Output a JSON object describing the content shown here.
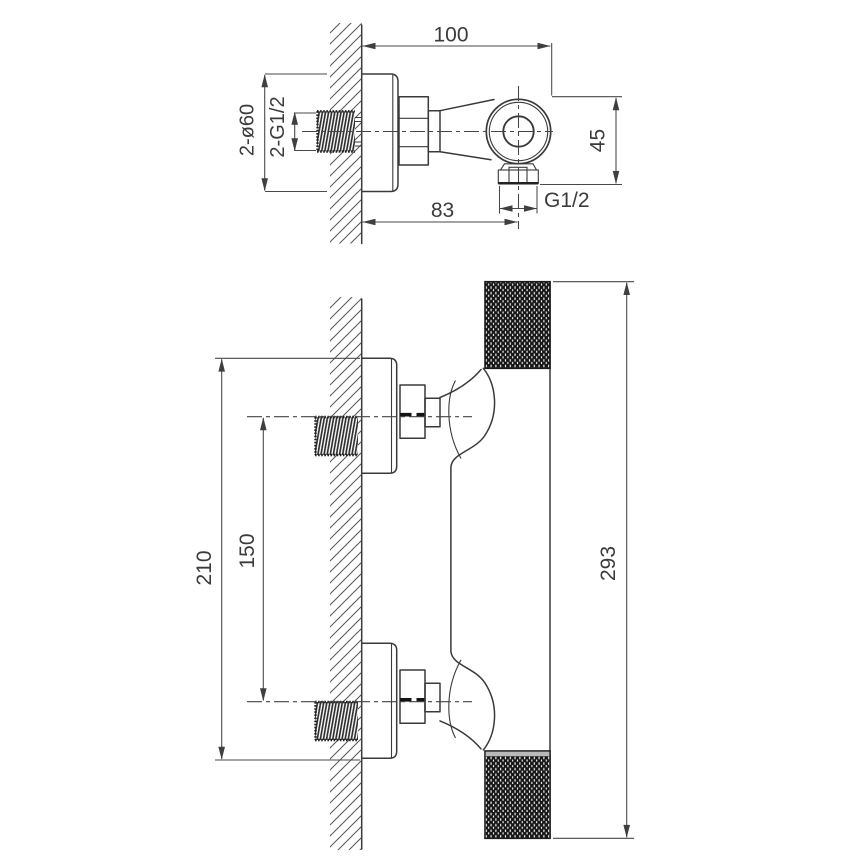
{
  "drawing": {
    "type": "dimensioned technical drawing",
    "subject": "wall-mounted shower mixer valve, two installation views",
    "units": "mm",
    "colors": {
      "line": "#3a3a3a",
      "dimension": "#4a4a4a",
      "knurl_dark": "#161616",
      "cap_highlight": "#b9b9b9",
      "background": "#ffffff"
    },
    "side_view": {
      "dims": {
        "wall_to_front": "100",
        "outlet_drop": "45",
        "wall_to_outlet": "83",
        "outlet_thread": "G1/2",
        "inlet_thread": "2-G1/2",
        "flange_diameter": "2-ø60"
      }
    },
    "front_view": {
      "dims": {
        "flange_outer_span": "210",
        "inlet_center_spacing": "150",
        "body_height": "293"
      }
    }
  }
}
